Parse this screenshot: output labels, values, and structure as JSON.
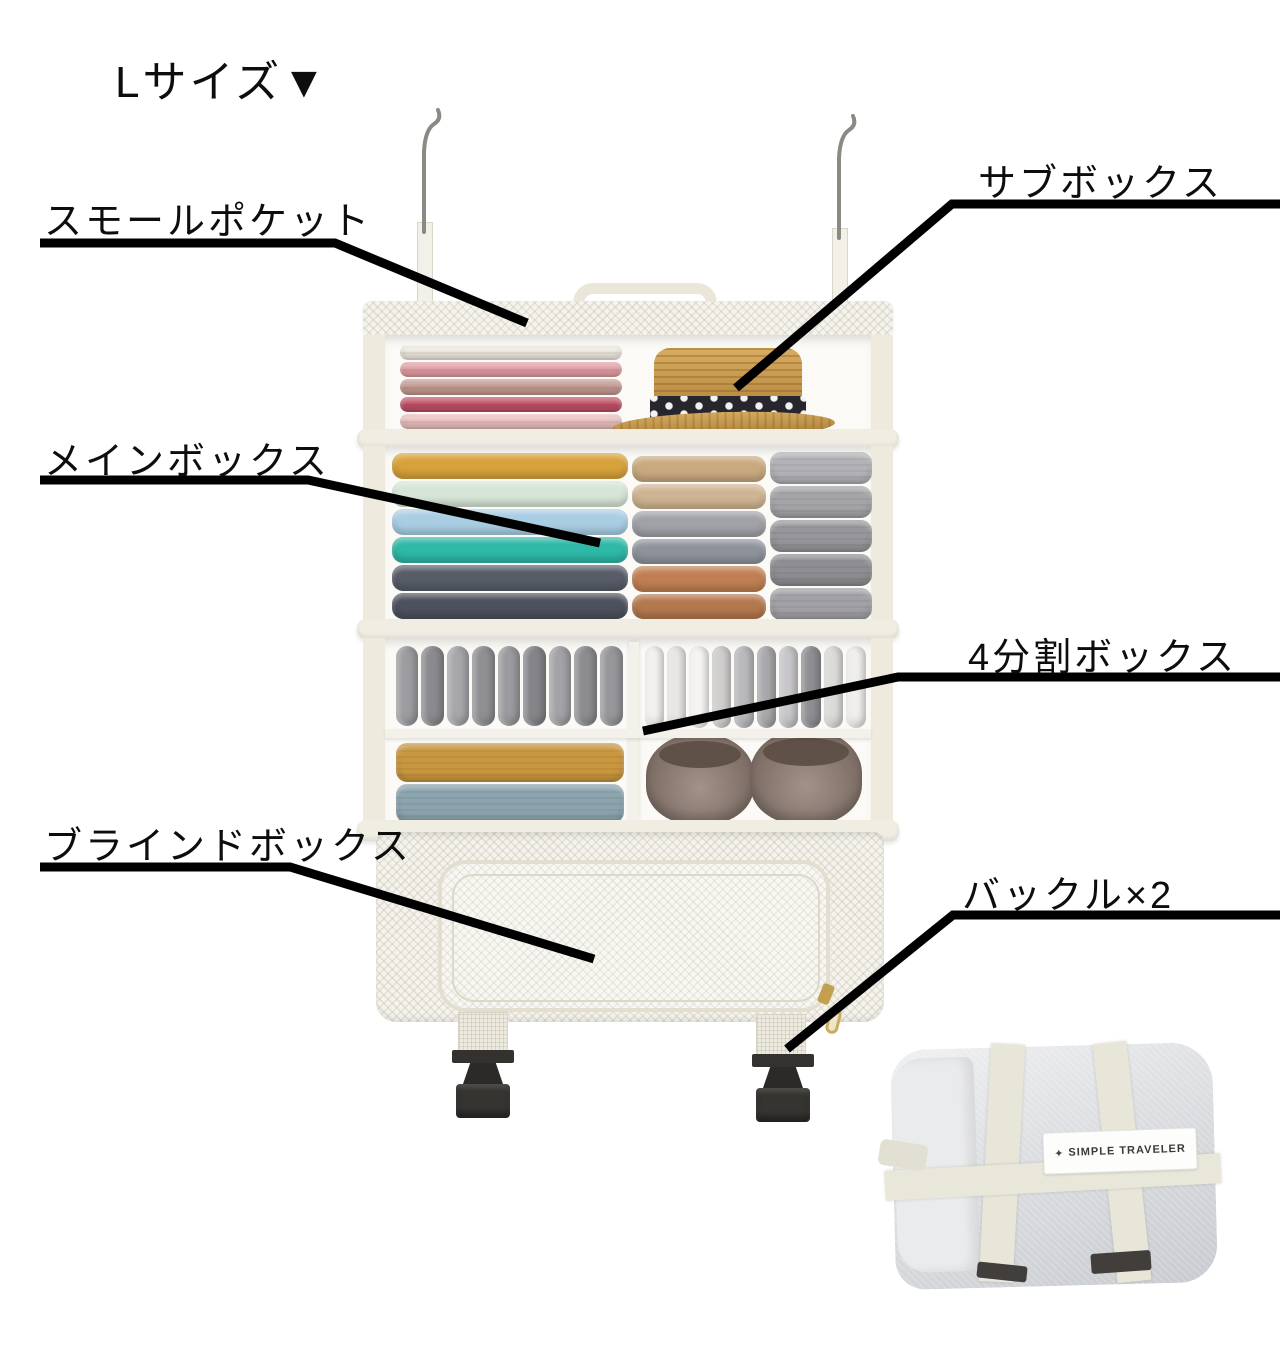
{
  "title": "Lサイズ▼",
  "labels": {
    "small_pocket": "スモールポケット",
    "sub_box": "サブボックス",
    "main_box": "メインボックス",
    "four_split_box": "4分割ボックス",
    "blind_box": "ブラインドボックス",
    "buckles": "バックル×2"
  },
  "bag": {
    "tag_icon": "✦",
    "tag": "SIMPLE TRAVELER"
  },
  "colors": {
    "leader_line": "#000000",
    "fabric_shell": "#efece1",
    "mesh": "#f5f3ec",
    "hat_straw": "#c3903f",
    "hat_band": "#26262c",
    "buckle_plastic": "#34322f",
    "slipper_brown": "#8d7a6f",
    "slipper_opening": "#5f5148",
    "towel_mustard": "#c9973f",
    "towel_blue": "#8ba4ae"
  },
  "items": {
    "sub_box_sweaters": [
      "#f1ece3",
      "#e5a0a6",
      "#c79c94",
      "#c25067",
      "#ecc3c0"
    ],
    "main_box_stack_left": [
      "#d8a23b",
      "#d6e5d7",
      "#a9cee4",
      "#2eb8a6",
      "#575c68",
      "#4d515d"
    ],
    "main_box_stack_middle": [
      "#c9a97f",
      "#cfb493",
      "#a0a2a7",
      "#8e939b",
      "#c07f52",
      "#b4784e"
    ],
    "main_box_stack_right": [
      "#b3b2b6",
      "#a5a4a8",
      "#97969a",
      "#8f8e92",
      "#a2a1a5"
    ],
    "socks_rolled_left": [
      "#9d9ca0",
      "#8b8a8e",
      "#a7a6aa",
      "#908f93",
      "#9b9a9e",
      "#858488",
      "#a3a2a6",
      "#8d8c90",
      "#97969a"
    ],
    "socks_folded_right": [
      "#f2f1ef",
      "#e8e7e5",
      "#f5f4f2",
      "#cfcecd",
      "#b9b8bb",
      "#a9a8ac",
      "#c7c6c9",
      "#8f8e92",
      "#dcdbd9",
      "#f0efed"
    ],
    "towels": [
      "#c9973f",
      "#8ba4ae"
    ]
  }
}
